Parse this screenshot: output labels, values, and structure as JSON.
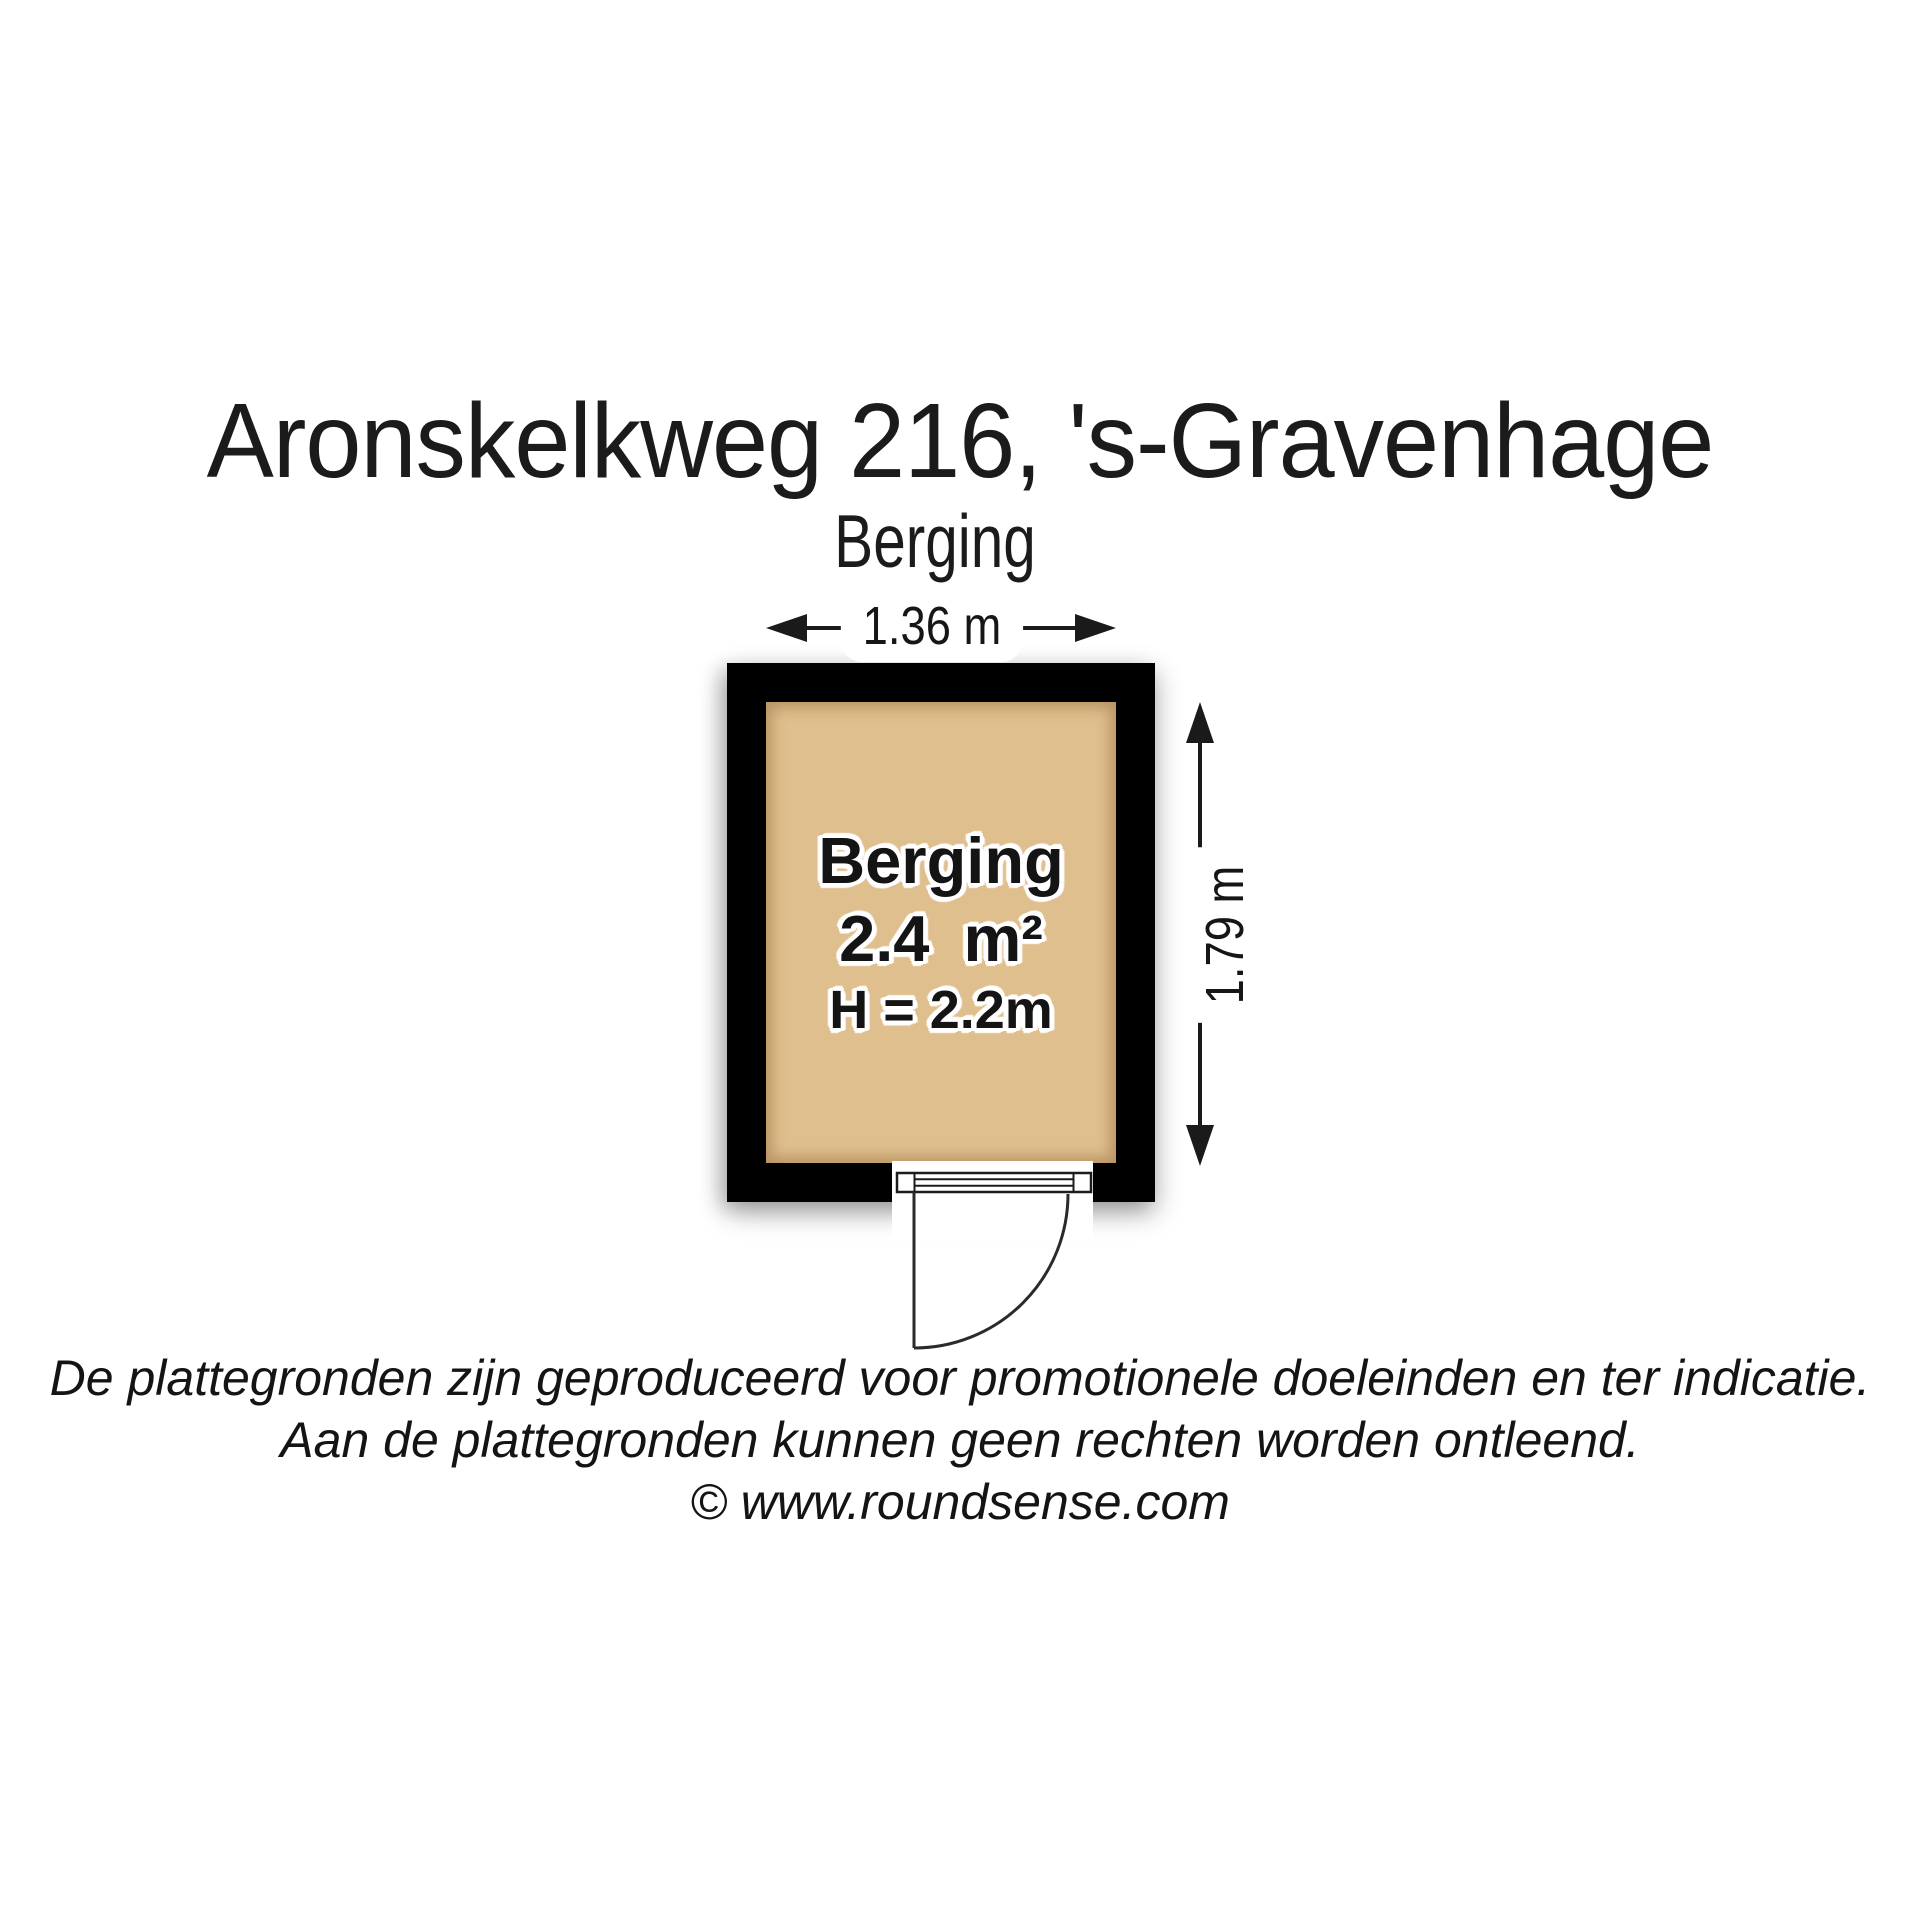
{
  "header": {
    "title": "Aronskelkweg 216, 's-Gravenhage",
    "subtitle": "Berging"
  },
  "plan": {
    "room": {
      "name": "Berging",
      "area": "2.4 m²",
      "ceiling_height": "H = 2.2m"
    },
    "dimensions": {
      "width": "1.36 m",
      "depth": "1.79 m"
    },
    "colors": {
      "wall": "#000000",
      "floor": "#e0bf8e",
      "floor_shade": "#c9a878",
      "line": "#1a1a1a"
    }
  },
  "footer": {
    "disclaimer_line1": "De plattegronden zijn geproduceerd voor promotionele doeleinden en ter indicatie.",
    "disclaimer_line2": "Aan de plattegronden kunnen geen rechten worden ontleend.",
    "credit": "© www.roundsense.com"
  }
}
